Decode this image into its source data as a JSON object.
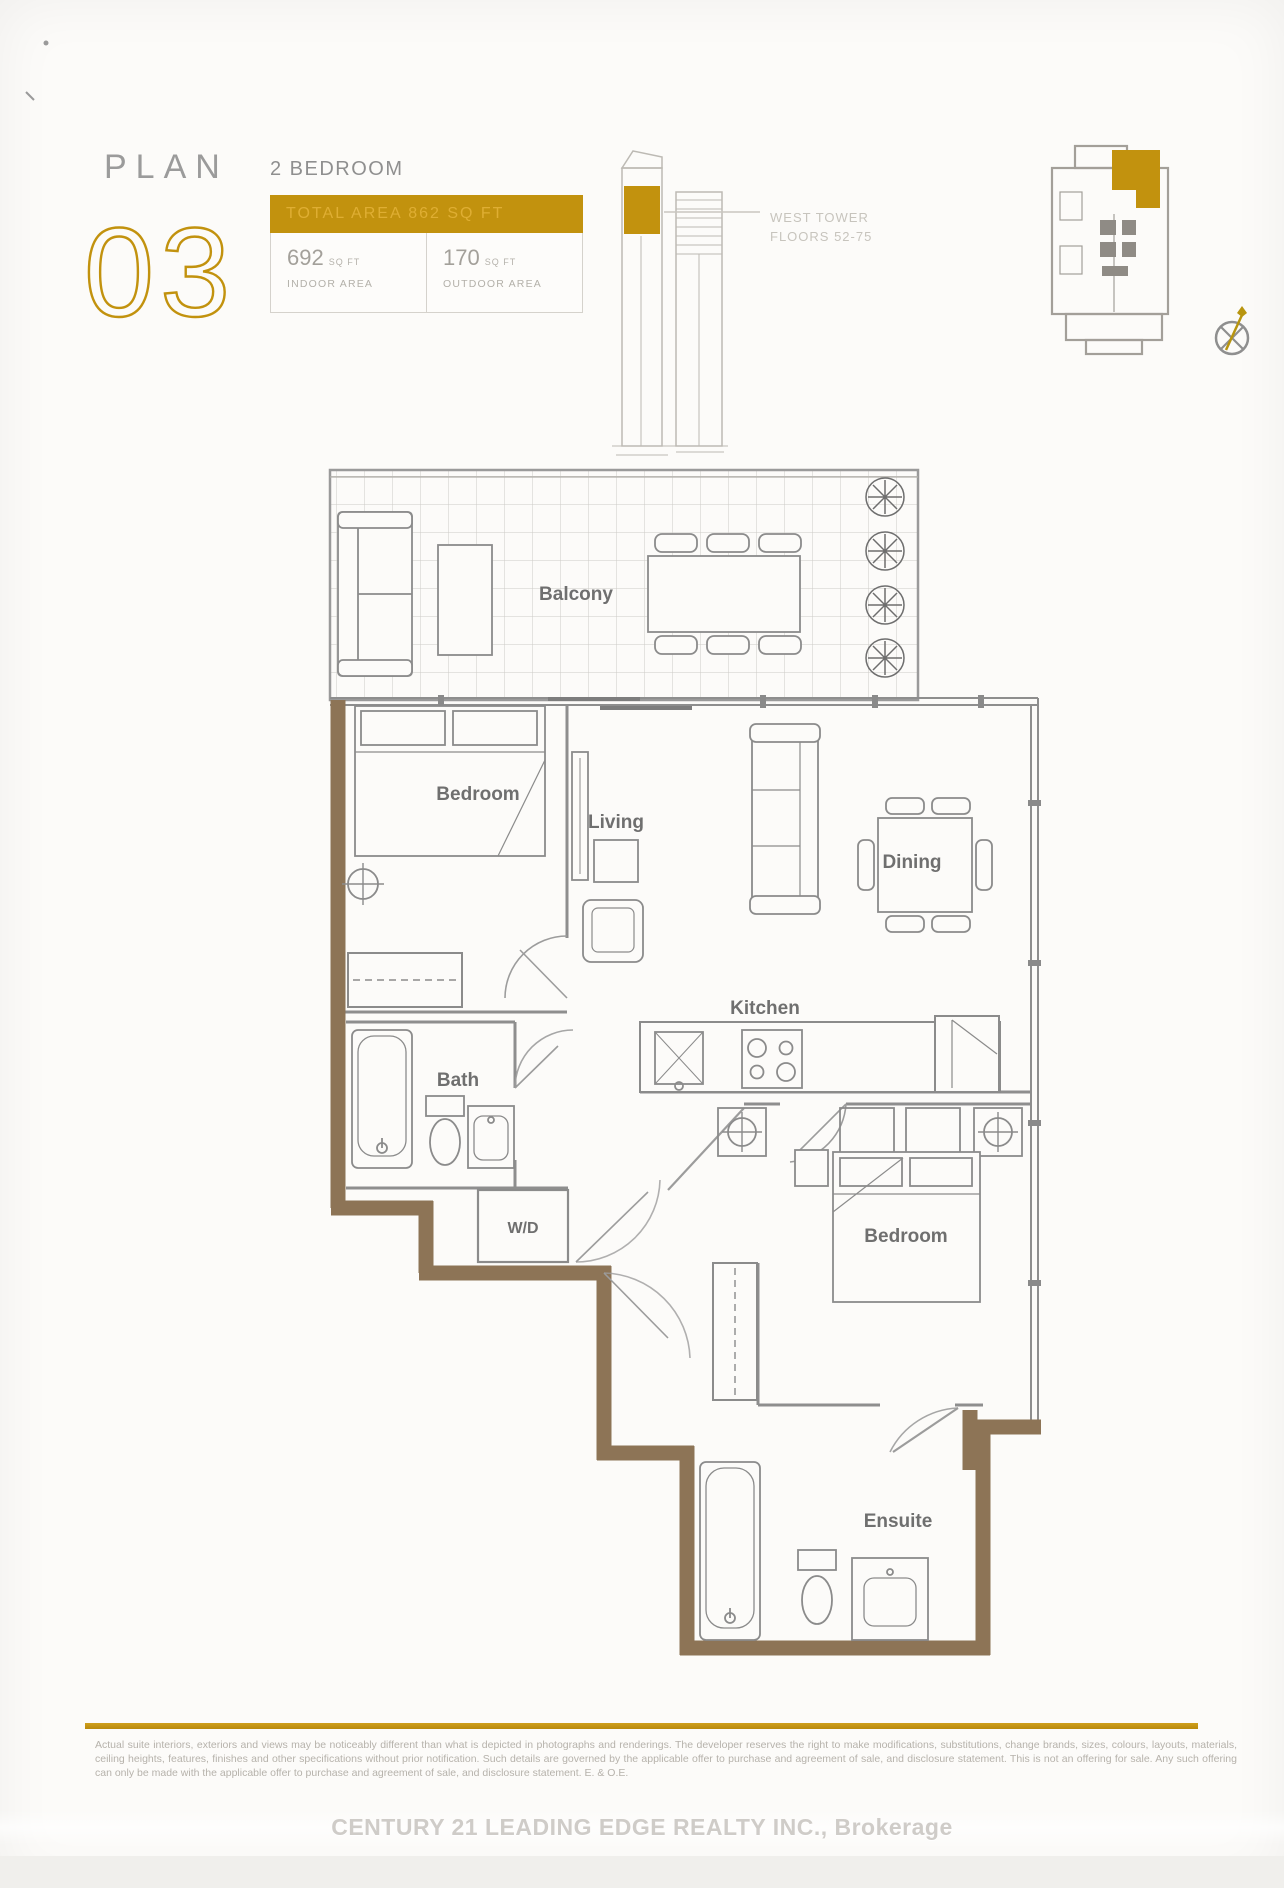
{
  "header": {
    "plan_label": "PLAN",
    "plan_number": "03",
    "unit_type": "2 BEDROOM",
    "total_area": "TOTAL AREA 862 SQ FT",
    "indoor_value": "692",
    "indoor_unit": "SQ FT",
    "indoor_label": "INDOOR AREA",
    "outdoor_value": "170",
    "outdoor_unit": "SQ FT",
    "outdoor_label": "OUTDOOR AREA",
    "tower_name": "WEST TOWER",
    "tower_floors": "FLOORS 52-75"
  },
  "floorplan": {
    "labels": {
      "balcony": "Balcony",
      "bedroom1": "Bedroom",
      "living": "Living",
      "dining": "Dining",
      "kitchen": "Kitchen",
      "washer_dryer": "W/D",
      "bath": "Bath",
      "bedroom2": "Bedroom",
      "ensuite": "Ensuite"
    }
  },
  "footer": {
    "disclaimer": "Actual suite interiors, exteriors and views may be noticeably different than what is depicted in photographs and renderings. The developer reserves the right to make modifications, substitutions, change brands, sizes, colours, layouts, materials, ceiling heights, features, finishes and other specifications without prior notification. Such details are governed by the applicable offer to purchase and agreement of sale, and disclosure statement. This is not an offering for sale. Any such offering can only be made with the applicable offer to purchase and agreement of sale, and disclosure statement. E. & O.E.",
    "watermark": "CENTURY 21 LEADING EDGE REALTY INC., Brokerage"
  },
  "colors": {
    "accent_gold": "#C2920E",
    "wall_brown": "#8D7456",
    "line_gray": "#8C8C8C"
  }
}
